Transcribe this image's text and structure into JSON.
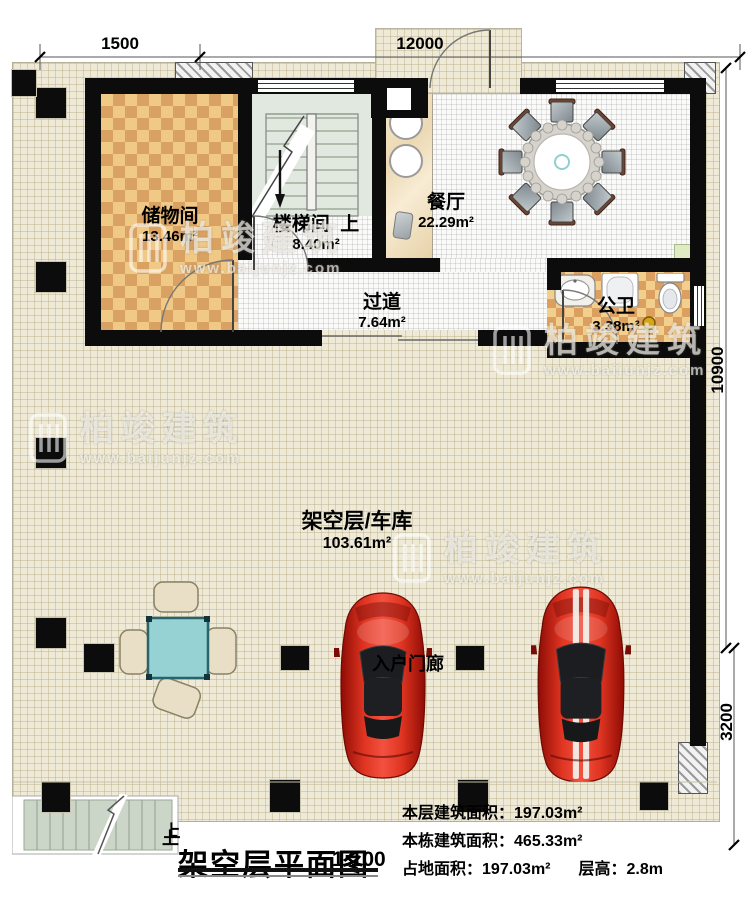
{
  "dims": {
    "top_left": "1500",
    "top_main": "12000",
    "right_upper": "10900",
    "right_lower": "3200"
  },
  "rooms": {
    "storage": {
      "name": "储物间",
      "area": "13.46m²"
    },
    "stairwell": {
      "name": "楼梯间",
      "area": "8.40m²",
      "up": "上"
    },
    "dining": {
      "name": "餐厅",
      "area": "22.29m²"
    },
    "corridor": {
      "name": "过道",
      "area": "7.64m²"
    },
    "bathroom": {
      "name": "公卫",
      "area": "3.38m²"
    },
    "garage": {
      "name": "架空层/车库",
      "area": "103.61m²"
    },
    "entry_porch": {
      "name": "入户门廊"
    }
  },
  "exterior": {
    "stair_up": "上"
  },
  "title_block": {
    "up": "上",
    "title": "架空层平面图",
    "scale": "1:100",
    "stats": {
      "line1_label": "本层建筑面积：",
      "line1_value": "197.03m²",
      "line2_label": "本栋建筑面积：",
      "line2_value": "465.33m²",
      "line3_label": "占地面积：",
      "line3_value": "197.03m²",
      "line3_label2": "层高：",
      "line3_value2": "2.8m"
    }
  },
  "watermark": {
    "brand": "柏竣建筑",
    "url": "www.baijunjz.com"
  },
  "colors": {
    "wall": "#0c0c0c",
    "deck": "#eeead7",
    "checker_light": "#f0c987",
    "checker_dark": "#d9a263",
    "car_red": "#cf1608",
    "table_teal": "#96d2d4",
    "stair_tread": "#ccd6c8"
  }
}
